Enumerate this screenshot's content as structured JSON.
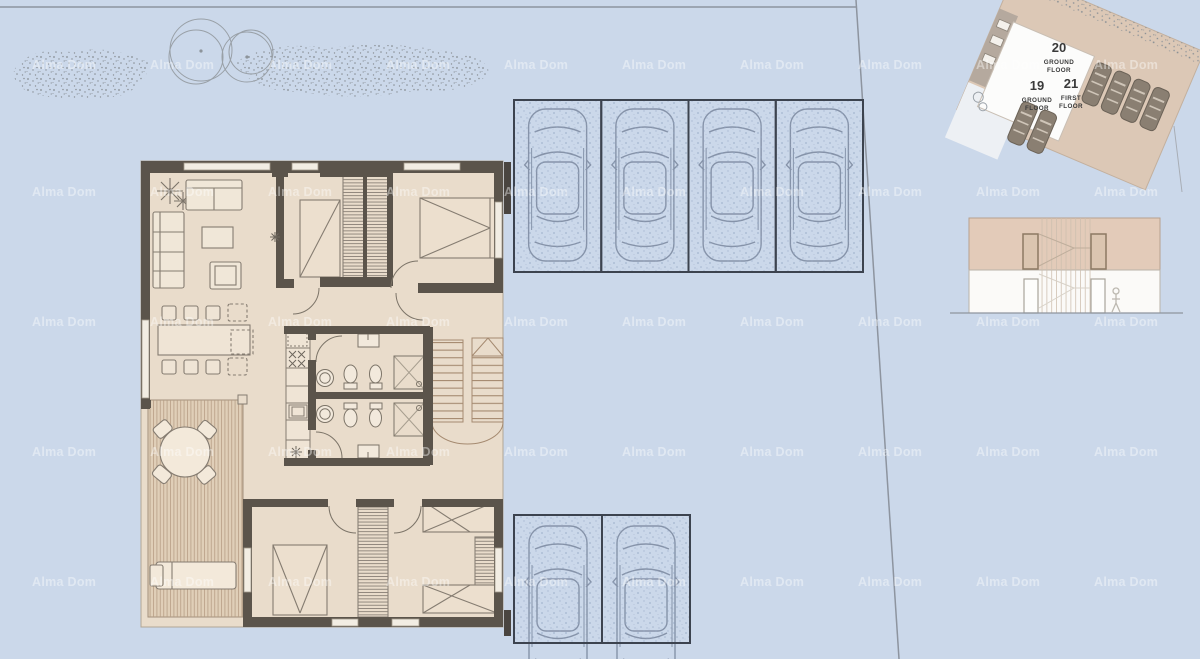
{
  "watermark": {
    "text": "Alma Dom"
  },
  "site_plan_inset": {
    "units": [
      {
        "number": "20",
        "floor_lines": [
          "GROUND",
          "FLOOR"
        ]
      },
      {
        "number": "19",
        "floor_lines": [
          "GROUND",
          "FLOOR"
        ]
      },
      {
        "number": "21",
        "floor_lines": [
          "FIRST",
          "FLOOR"
        ]
      }
    ]
  },
  "parking": {
    "top_row_spaces": 4,
    "bottom_row_spaces": 2
  },
  "colors": {
    "background": "#cbd8ea",
    "floor": "#e9dccb",
    "terrace": "#e0cfb8",
    "walls": "#5b544b",
    "parking_outline": "#3c434f",
    "car_line": "#8390a6",
    "site_plan_tan": "#dcc8b6",
    "inset_car": "#8a7f72",
    "elevation_upper": "#e3cbb9",
    "watermark": "#ffffff"
  }
}
